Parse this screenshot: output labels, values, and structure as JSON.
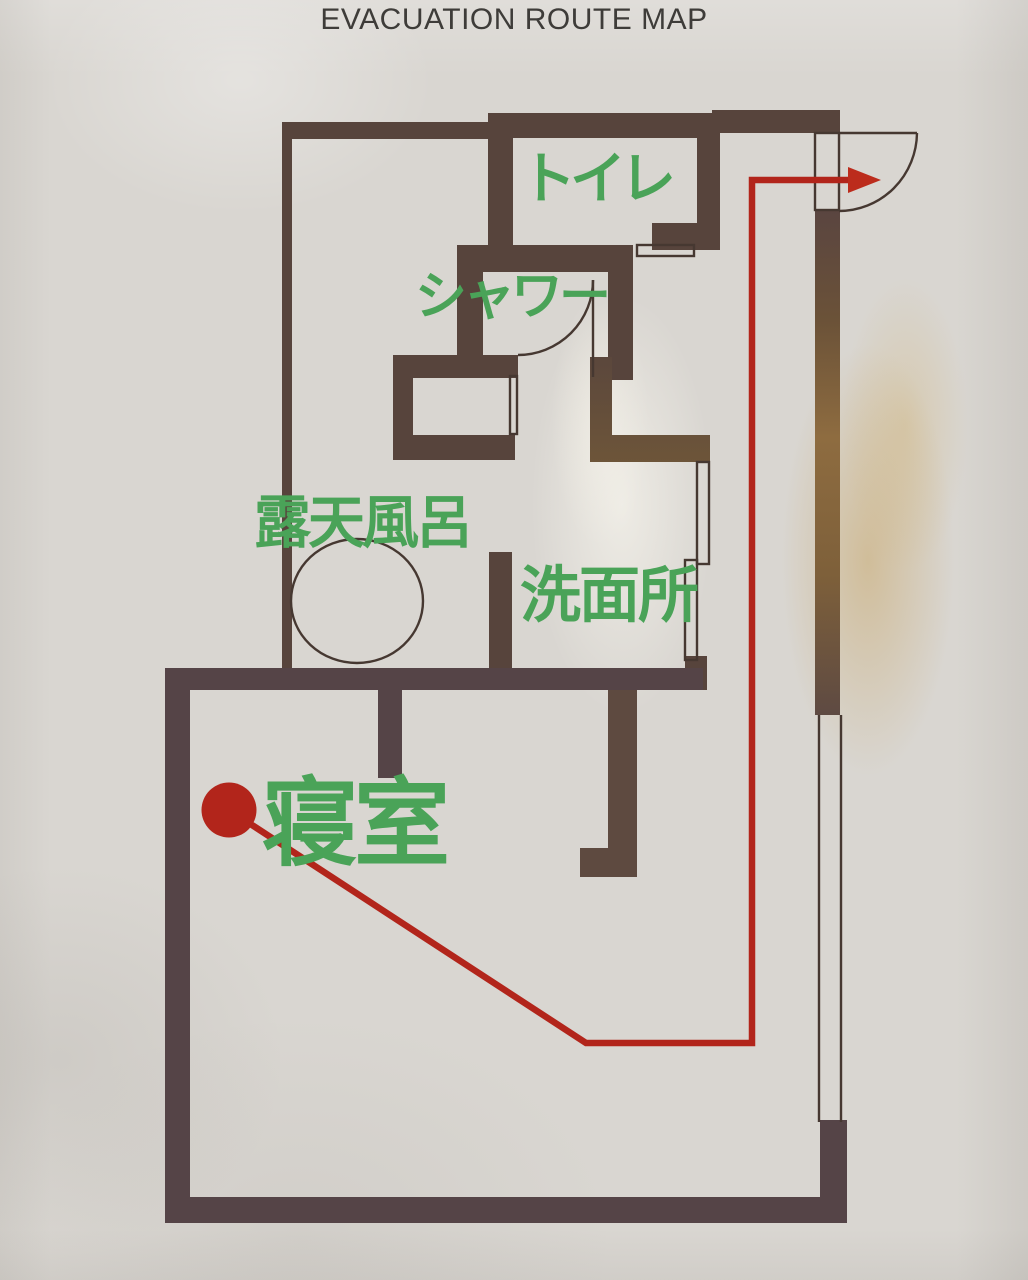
{
  "title": "EVACUATION ROUTE MAP",
  "rooms": [
    {
      "name": "toilet",
      "label": "トイレ"
    },
    {
      "name": "shower",
      "label": "シャワー"
    },
    {
      "name": "open-air-bath",
      "label": "露天風呂"
    },
    {
      "name": "washroom",
      "label": "洗面所"
    },
    {
      "name": "bedroom",
      "label": "寝室"
    }
  ],
  "route": {
    "start_room": "寝室",
    "points": [
      [
        229,
        810
      ],
      [
        586,
        1043
      ],
      [
        752,
        1043
      ],
      [
        752,
        180
      ],
      [
        851,
        180
      ]
    ],
    "arrow_tip": [
      881,
      180
    ],
    "start_dot": {
      "x": 229,
      "y": 810,
      "r": 27.5
    }
  },
  "colors": {
    "paper": "#d9d6d1",
    "wall": "#57443c",
    "wall_shadow": "#554447",
    "wall_glare": "#8e6c40",
    "label_green": "#4aa358",
    "route_red": "#b2251b",
    "title_text": "#3e3c39"
  }
}
